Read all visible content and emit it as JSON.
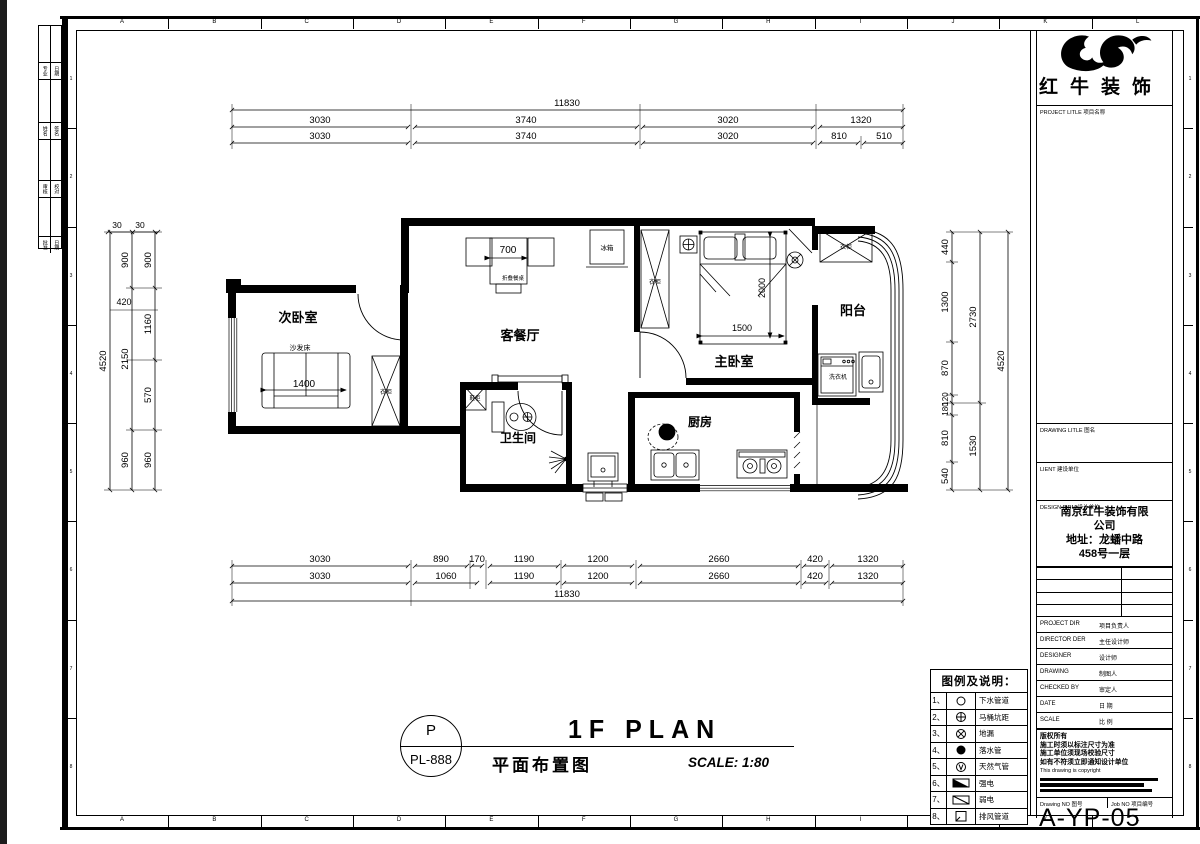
{
  "sheet": {
    "grid_letters": [
      "A",
      "B",
      "C",
      "D",
      "E",
      "F",
      "G",
      "H",
      "I",
      "J",
      "K",
      "L"
    ],
    "grid_numbers": [
      "1",
      "2",
      "3",
      "4",
      "5",
      "6",
      "7",
      "8"
    ]
  },
  "logo": {
    "name": "红牛装饰"
  },
  "stamp": {
    "letter": "P",
    "code": "PL-888"
  },
  "plan_title": {
    "en": "1F PLAN",
    "cn": "平面布置图",
    "scale": "SCALE: 1:80"
  },
  "signature_strip": {
    "rows": [
      [
        "专业",
        "日期"
      ],
      [
        "姓名",
        "签名"
      ],
      [
        "审核",
        "校对"
      ],
      [
        "批准",
        "日期"
      ]
    ]
  },
  "titleblock": {
    "project_label": "PROJECT LITLE 项目名称",
    "drawing_label": "DRAWING LITLE 图名",
    "client_label": "LIENT 建设单位",
    "firm_label": "DESIGN FIRM 设计单位",
    "firm_lines": [
      "南京红牛装饰有限",
      "公司",
      "地址：龙蟠中路",
      "458号一层"
    ],
    "rows": [
      {
        "en": "PROJECT DIR",
        "cn": "项目负责人"
      },
      {
        "en": "DIRECTOR DER",
        "cn": "主任设计师"
      },
      {
        "en": "DESIGNER",
        "cn": "设计师"
      },
      {
        "en": "DRAWING",
        "cn": "制图人"
      },
      {
        "en": "CHECKED BY",
        "cn": "审定人"
      },
      {
        "en": "DATE",
        "cn": "日 期"
      },
      {
        "en": "SCALE",
        "cn": "比 例"
      }
    ],
    "copyright_cn": [
      "版权所有",
      "施工时须以标注尺寸为准",
      "施工单位须现场校验尺寸",
      "如有不符须立即通知设计单位"
    ],
    "copyright_en": "This drawing is copyright",
    "drawing_no_label": "Drawing NO 图号",
    "job_no_label": "Job NO 项目编号",
    "drawing_no": "A-YP-05"
  },
  "legend": {
    "title": "图例及说明：",
    "items": [
      {
        "no": "1、",
        "symbol": "circle",
        "label": "下水管道"
      },
      {
        "no": "2、",
        "symbol": "circle-cross",
        "label": "马桶坑距"
      },
      {
        "no": "3、",
        "symbol": "circle-x",
        "label": "地漏"
      },
      {
        "no": "4、",
        "symbol": "circle-filled",
        "label": "落水管"
      },
      {
        "no": "5、",
        "symbol": "circle-v",
        "label": "天然气管"
      },
      {
        "no": "6、",
        "symbol": "rect-half-filled",
        "label": "强电"
      },
      {
        "no": "7、",
        "symbol": "rect-diagonal",
        "label": "弱电"
      },
      {
        "no": "8、",
        "symbol": "rect-corner",
        "label": "排风管道"
      }
    ]
  },
  "rooms": {
    "bedroom2": "次卧室",
    "living": "客餐厅",
    "master": "主卧室",
    "balcony": "阳台",
    "bath": "卫生间",
    "kitchen": "厨房"
  },
  "furniture": {
    "sofa_bed": "沙发床",
    "sofa_dim": "1400",
    "wardrobe": "衣柜",
    "folding_table": "折叠餐桌",
    "table_dim": "700",
    "fridge": "冰箱",
    "bed_len": "2000",
    "bed_wid": "1500",
    "washer": "洗衣机",
    "shoe_cab": "鞋柜"
  },
  "dims": {
    "top1": [
      "11830"
    ],
    "top2": [
      "3030",
      "3740",
      "3020",
      "1320"
    ],
    "top3": [
      "3030",
      "3740",
      "3020",
      "810",
      "510"
    ],
    "bottom1": [
      "3030",
      "890",
      "170",
      "1190",
      "1200",
      "2660",
      "420",
      "1320"
    ],
    "bottom2": [
      "3030",
      "1060",
      "1190",
      "1200",
      "2660",
      "420",
      "1320"
    ],
    "bottom3": [
      "11830"
    ],
    "left_top": [
      "30",
      "30"
    ],
    "left_inner": [
      "900",
      "1160",
      "570",
      "960"
    ],
    "left_mid": [
      "900",
      "2150",
      "960"
    ],
    "left_mid_extra": "420",
    "left_outer": "4520",
    "right_inner": [
      "440",
      "1300",
      "870",
      "120",
      "180",
      "810",
      "540"
    ],
    "right_mid": [
      "2730",
      "1530"
    ],
    "right_outer": "4520"
  }
}
